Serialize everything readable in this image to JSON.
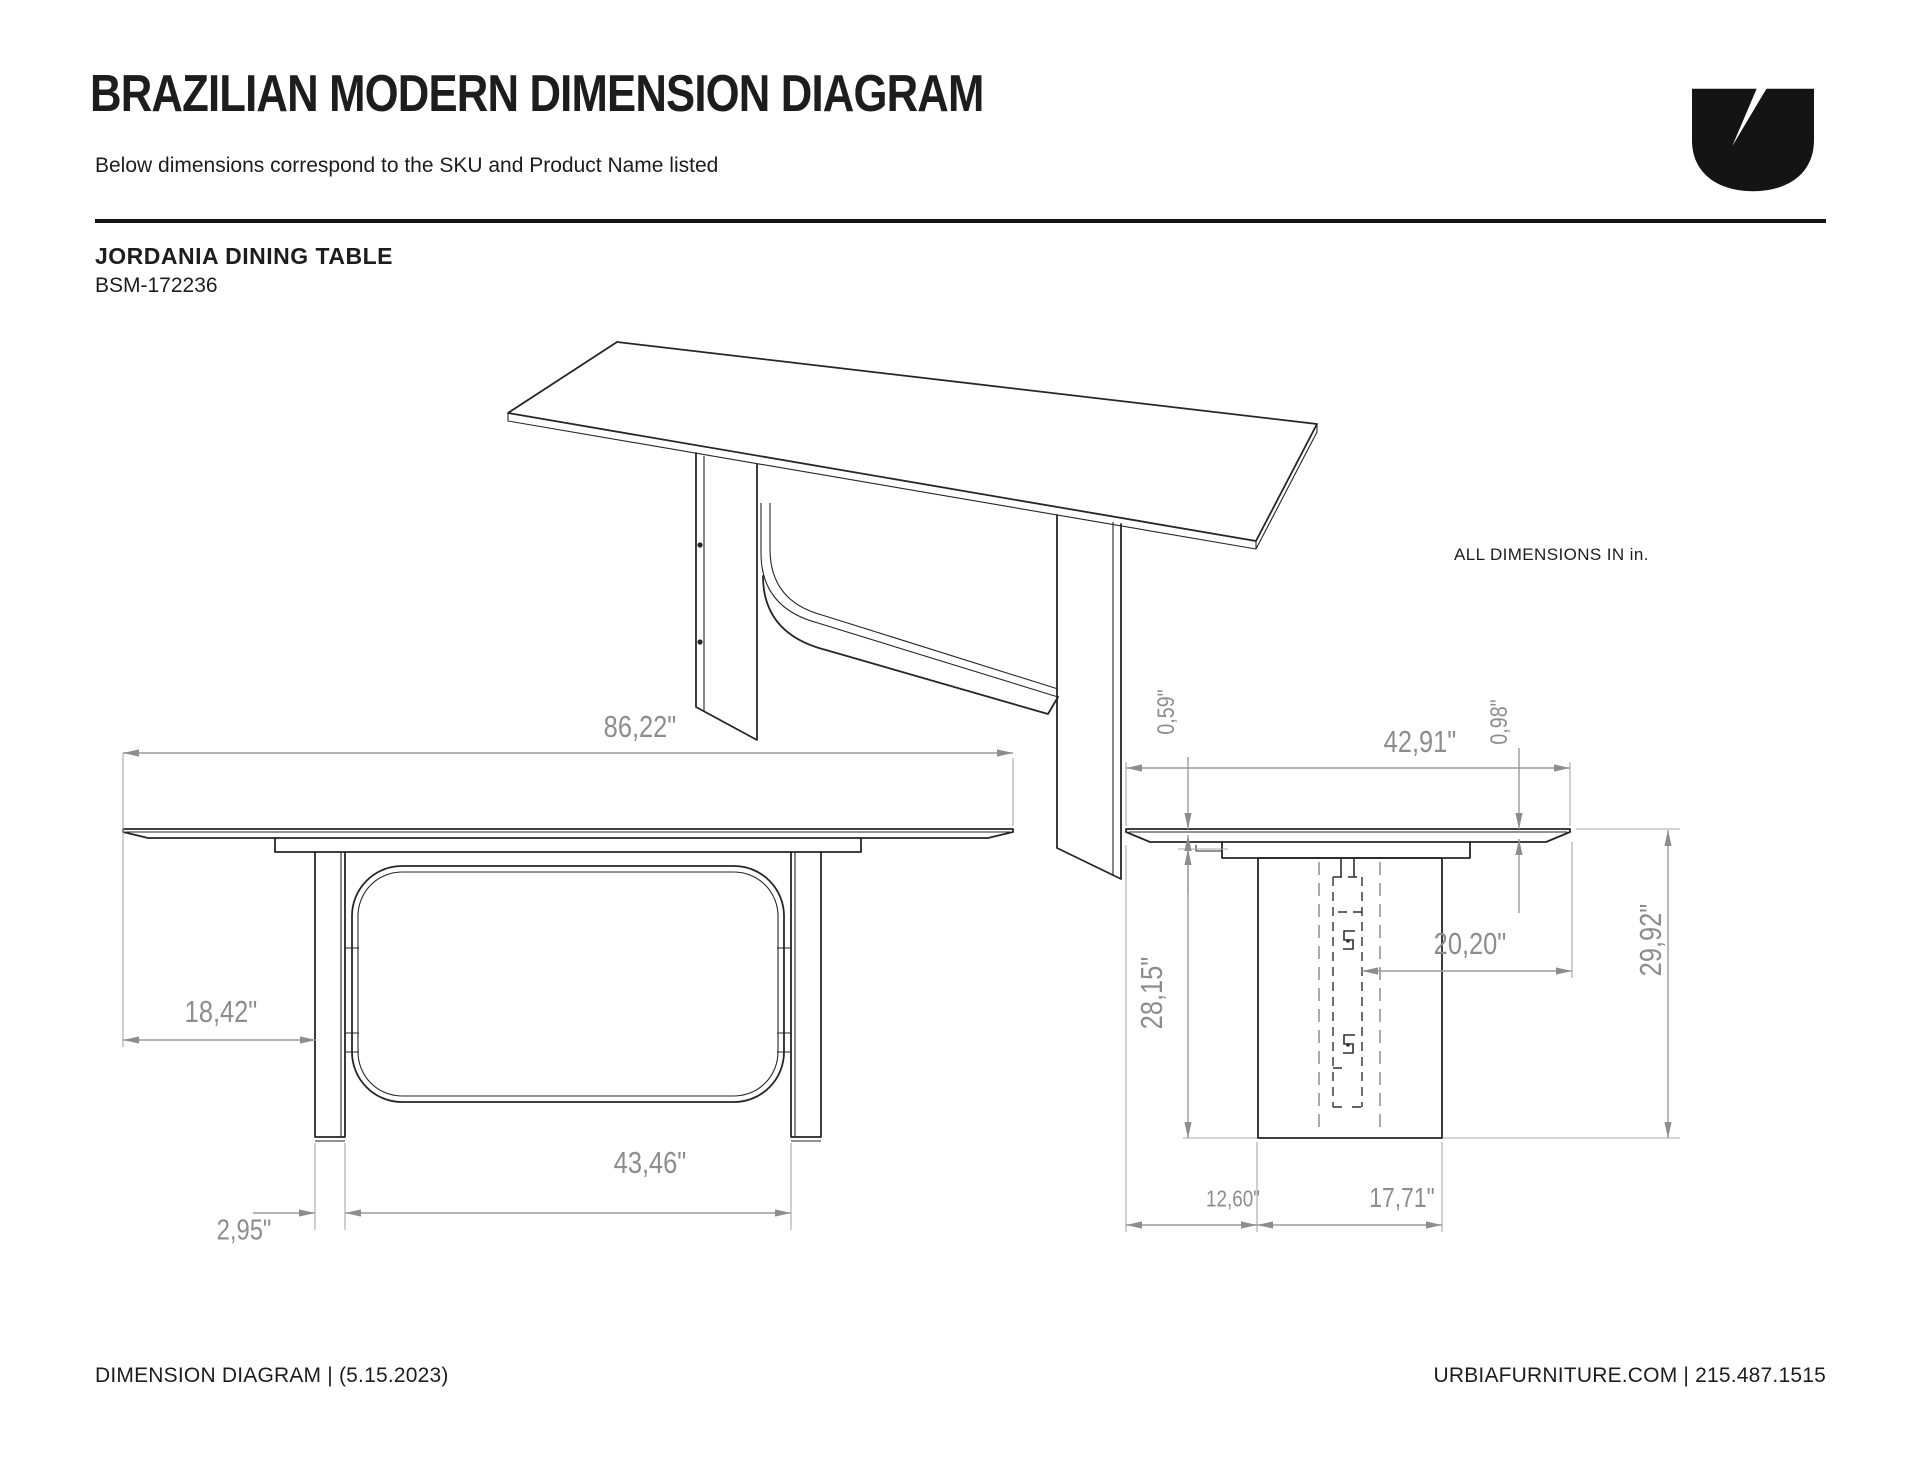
{
  "header": {
    "title": "BRAZILIAN MODERN DIMENSION DIAGRAM",
    "subtitle": "Below dimensions correspond to the SKU and Product Name listed"
  },
  "product": {
    "name": "JORDANIA DINING TABLE",
    "sku": "BSM-172236"
  },
  "note": "ALL DIMENSIONS IN in.",
  "dimensions": {
    "front": {
      "total_width": "86,22\"",
      "top_overhang": "18,42\"",
      "leg_thickness": "2,95\"",
      "inner_span": "43,46\""
    },
    "side": {
      "total_depth": "42,91\"",
      "top_thickness": "0,59\"",
      "edge_thickness": "0,98\"",
      "underside_height": "28,15\"",
      "center_to_edge": "20,20\"",
      "total_height": "29,92\"",
      "side_overhang": "12,60\"",
      "pedestal_depth": "17,71\""
    }
  },
  "footer": {
    "left": "DIMENSION DIAGRAM | (5.15.2023)",
    "right": "URBIAFURNITURE.COM  |  215.487.1515"
  },
  "colors": {
    "ink": "#1d1d1d",
    "dim_gray": "#8d8d8d",
    "line_black": "#262626"
  }
}
